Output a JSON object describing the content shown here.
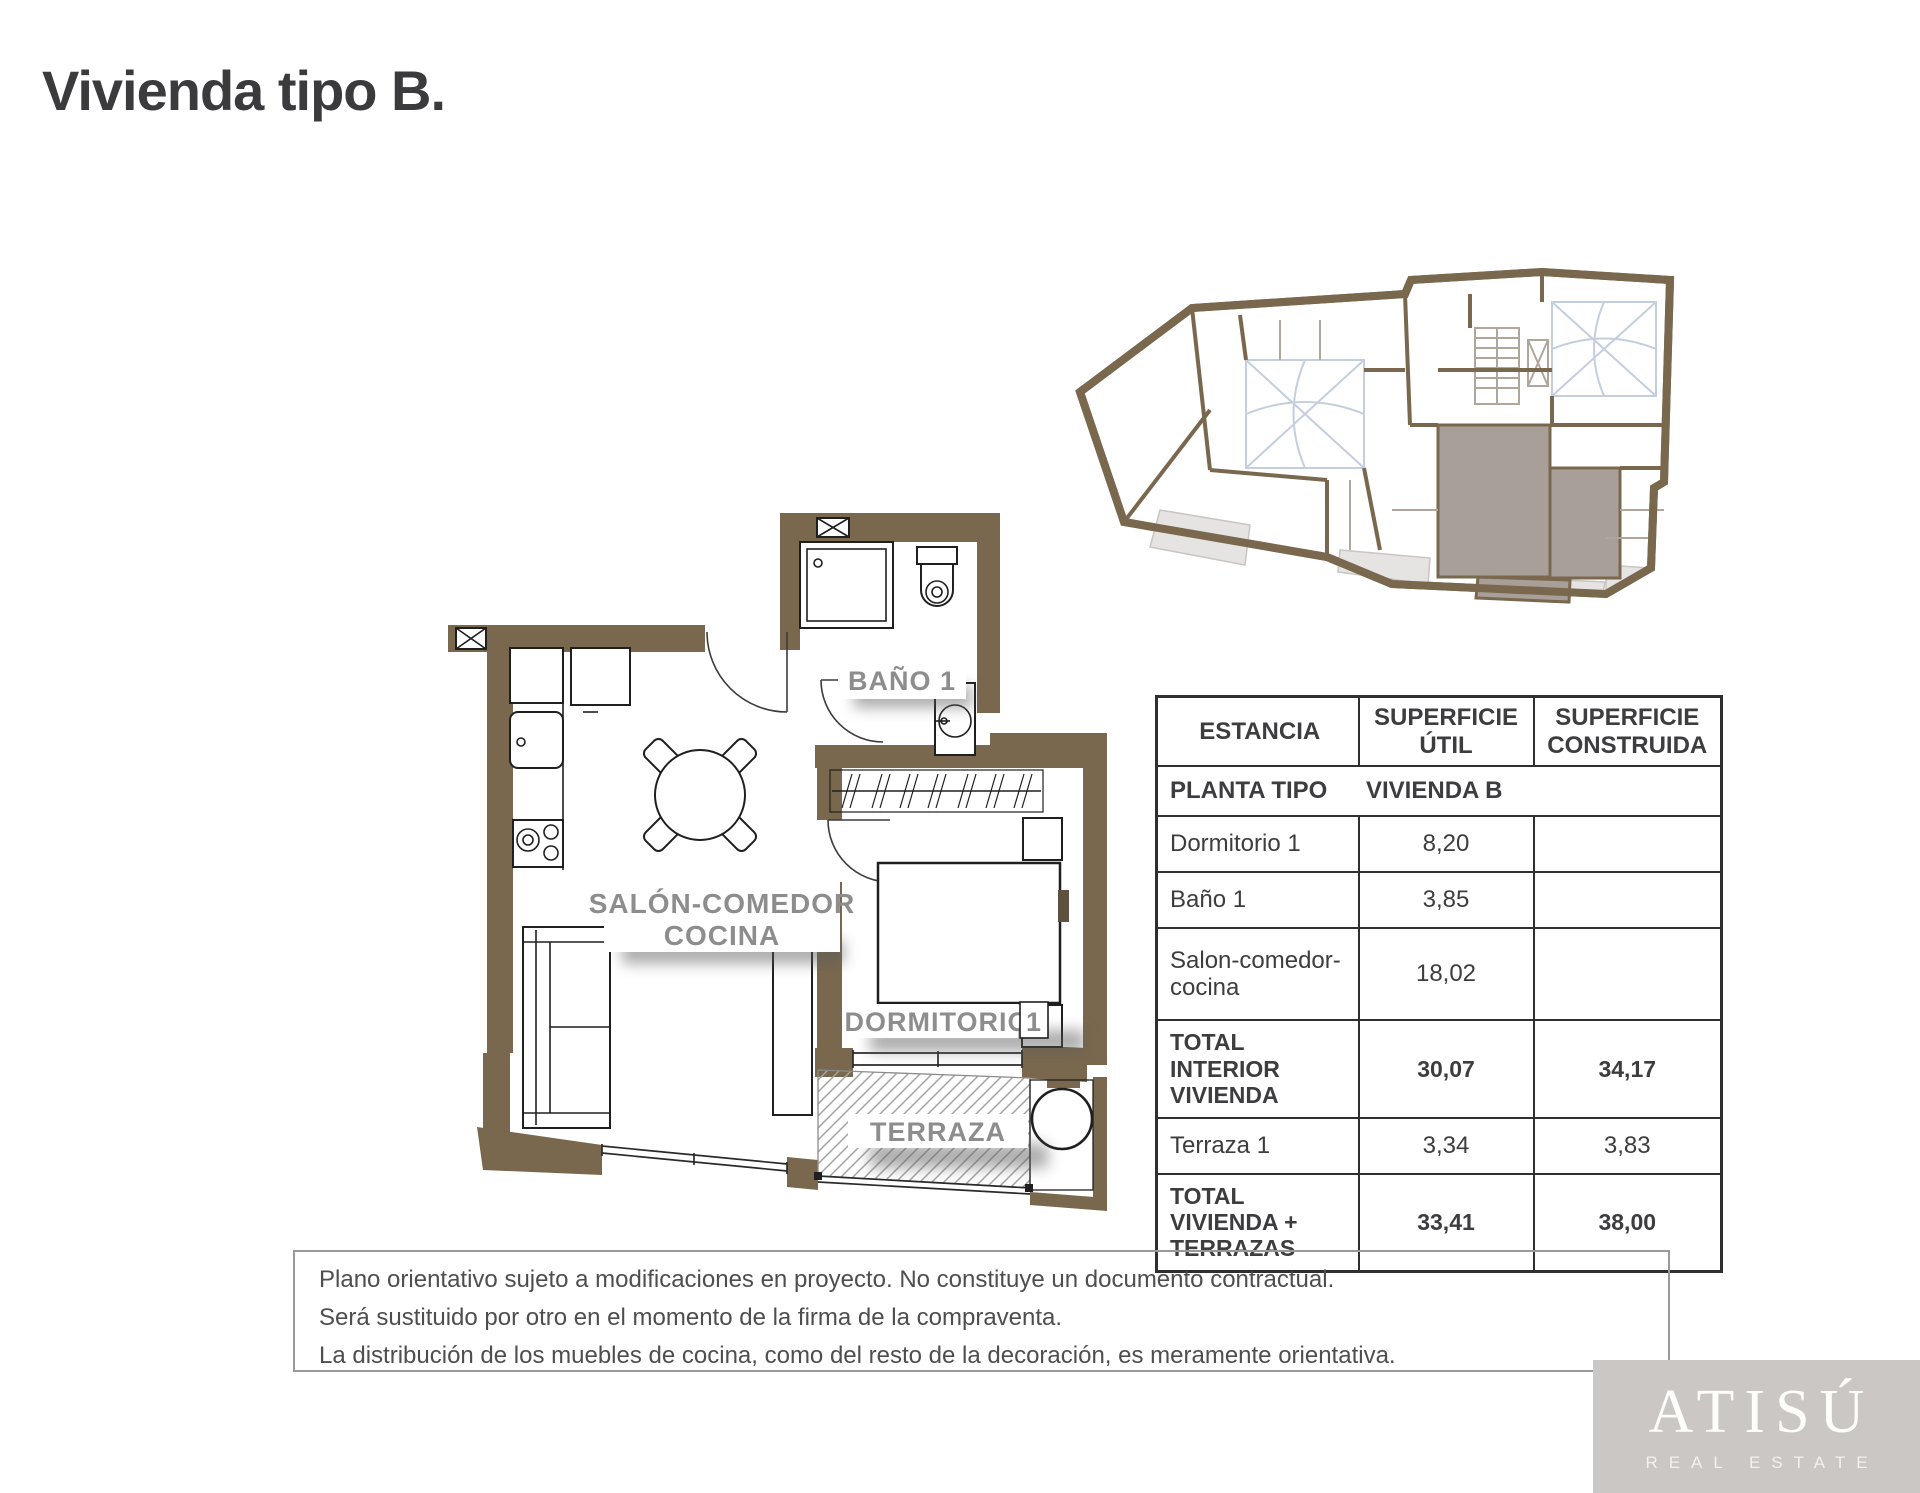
{
  "page": {
    "title": "Vivienda tipo B."
  },
  "plan": {
    "labels": {
      "bathroom": "BAÑO 1",
      "living_line1": "SALÓN-COMEDOR",
      "living_line2": "COCINA",
      "bedroom": "DORMITORIO",
      "bedroom_number": "1",
      "terrace": "TERRAZA"
    }
  },
  "table": {
    "headers": [
      "ESTANCIA",
      "SUPERFICIE ÚTIL",
      "SUPERFICIE CONSTRUIDA"
    ],
    "plant_row": {
      "label": "PLANTA TIPO",
      "value": "VIVIENDA B"
    },
    "rows": [
      {
        "estancia": "Dormitorio 1",
        "util": "8,20",
        "construida": ""
      },
      {
        "estancia": "Baño 1",
        "util": "3,85",
        "construida": ""
      },
      {
        "estancia": "Salon-comedor-cocina",
        "util": "18,02",
        "construida": ""
      },
      {
        "estancia": "TOTAL INTERIOR VIVIENDA",
        "util": "30,07",
        "construida": "34,17"
      },
      {
        "estancia": "Terraza 1",
        "util": "3,34",
        "construida": "3,83"
      },
      {
        "estancia": "TOTAL VIVIENDA + TERRAZAS",
        "util": "33,41",
        "construida": "38,00"
      }
    ]
  },
  "disclaimer": {
    "line1": "Plano orientativo sujeto a modificaciones en proyecto. No constituye un documento contractual.",
    "line2": "Será sustituido por otro en el momento de la firma de la compraventa.",
    "line3": "La distribución de los muebles de cocina, como del resto de la decoración, es meramente orientativa."
  },
  "logo": {
    "name": "ATISÚ",
    "tagline": "REAL ESTATE"
  },
  "colors": {
    "wall": "#7a684e",
    "highlight": "#a99f99",
    "label": "#8d8d8d",
    "line": "#2a2a2a",
    "logo_bg": "#cac7c4",
    "courtyard": "#c3cede",
    "title": "#3b3b3d",
    "table_text": "#3d3d3f"
  }
}
